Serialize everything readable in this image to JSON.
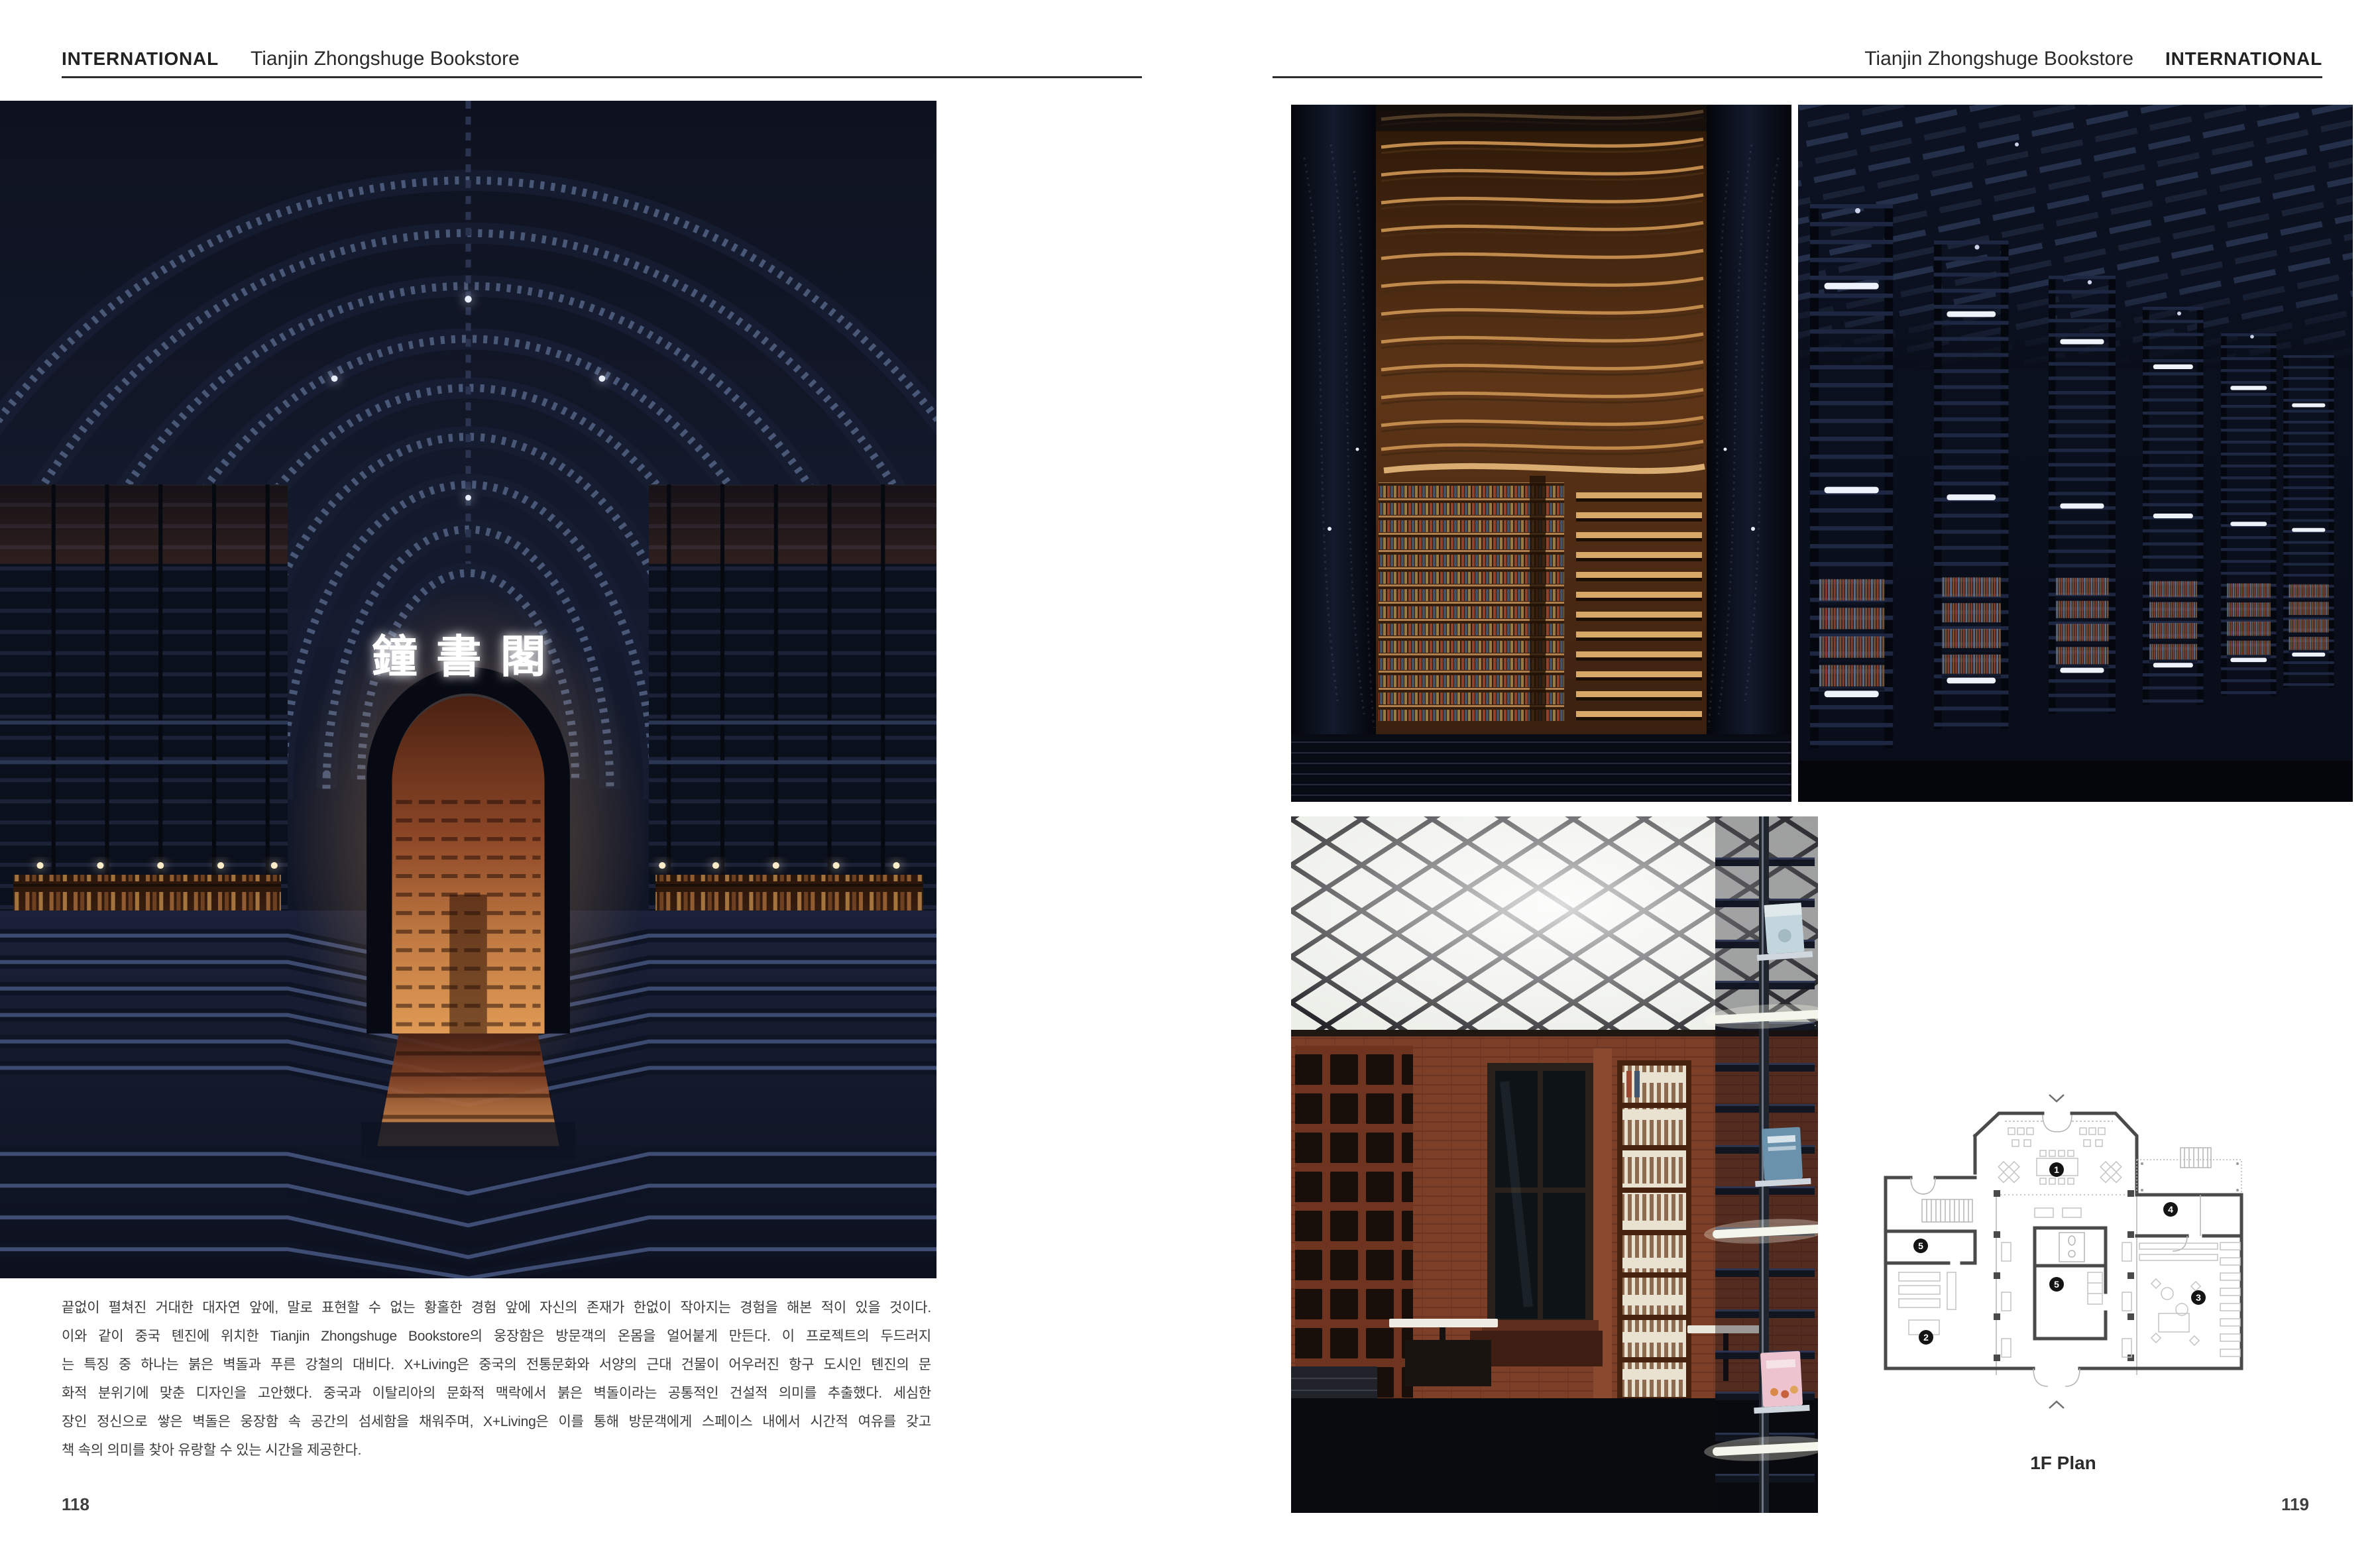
{
  "left_page": {
    "header": {
      "section": "INTERNATIONAL",
      "title": "Tianjin Zhongshuge Bookstore"
    },
    "body_lines": [
      "끝없이 펼쳐진 거대한 대자연 앞에, 말로 표현할 수 없는 황홀한 경험 앞에 자신의 존재가 한없이 작아지는 경험을 해본 적이 있을 것이다.",
      "이와 같이 중국 톈진에 위치한 Tianjin Zhongshuge Bookstore의 웅장함은 방문객의 온몸을 얼어붙게 만든다. 이 프로젝트의 두드러지",
      "는 특징 중 하나는 붉은 벽돌과 푸른 강철의 대비다. X+Living은 중국의 전통문화와 서양의 근대 건물이 어우러진 항구 도시인 톈진의 문",
      "화적 분위기에 맞춘 디자인을 고안했다. 중국과 이탈리아의 문화적 맥락에서 붉은 벽돌이라는 공통적인 건설적 의미를 추출했다. 세심한",
      "장인 정신으로 쌓은 벽돌은 웅장함 속 공간의 섬세함을 채워주며, X+Living은 이를 통해 방문객에게 스페이스 내에서 시간적 여유를 갖고",
      "책 속의 의미를 찾아 유랑할 수 있는 시간을 제공한다."
    ],
    "page_number": "118"
  },
  "right_page": {
    "header": {
      "title": "Tianjin Zhongshuge Bookstore",
      "section": "INTERNATIONAL"
    },
    "floor_plan": {
      "caption": "1F Plan",
      "markers": {
        "hall": "1",
        "left_lower": "2",
        "right_lower": "3",
        "right_room": "4",
        "left_room": "5",
        "core": "5"
      }
    },
    "page_number": "119"
  },
  "photos": {
    "main_hall_neon_sign": "鐘書閣"
  },
  "colors": {
    "page_bg": "#ffffff",
    "rule": "#2b2b2b",
    "body_text": "#3c3c3c",
    "photo_navy": "#10141f",
    "arch_steel_blue": "#4a5878",
    "brick": "#96522e",
    "wood": "#bf8a4b"
  }
}
